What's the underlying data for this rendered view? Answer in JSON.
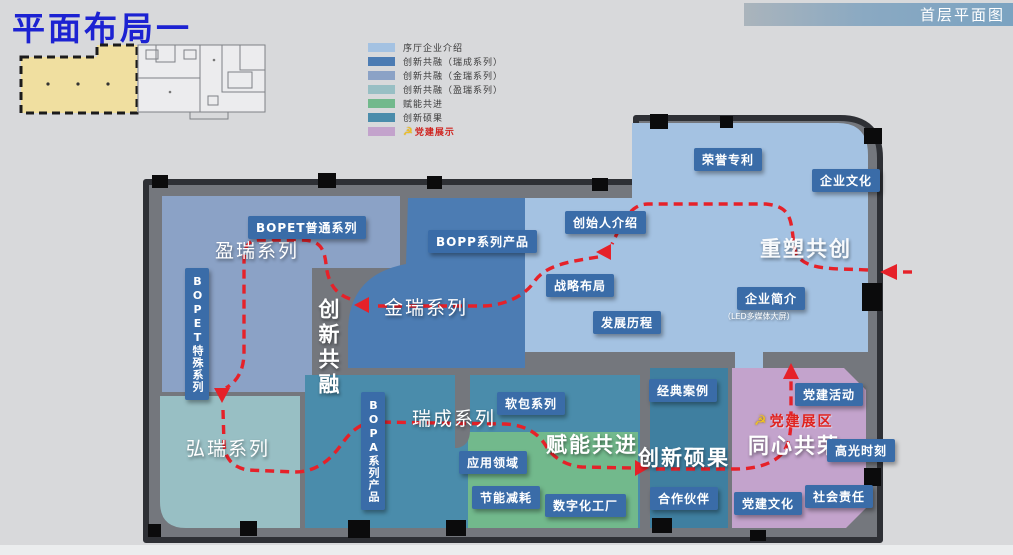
{
  "title": "平面布局一",
  "header": {
    "right_label": "首层平面图"
  },
  "legend": {
    "items": [
      {
        "label": "序厅企业介绍",
        "color": "#a4c2e2"
      },
      {
        "label": "创新共融（瑞成系列）",
        "color": "#4c7cb3"
      },
      {
        "label": "创新共融（金瑞系列）",
        "color": "#8ba2c6"
      },
      {
        "label": "创新共融（盈瑞系列）",
        "color": "#98bfc4"
      },
      {
        "label": "赋能共进",
        "color": "#72b98c"
      },
      {
        "label": "创新硕果",
        "color": "#4a8cab"
      },
      {
        "label": "党建展示",
        "color": "#c3a3cc",
        "text_color": "#cf2420",
        "icon": "party-emblem"
      }
    ]
  },
  "map": {
    "party_emblem_glyph": "☭",
    "zone_titles": {
      "yingrui": "盈瑞系列",
      "jinrui": "金瑞系列",
      "hongrui": "弘瑞系列",
      "ruicheng": "瑞成系列",
      "chuangxin_gongrong": "创新共融",
      "chongsu_gongchuang": "重塑共创",
      "funeng_gongjin": "赋能共进",
      "chuangxin_shuoguo": "创新硕果",
      "tongxin_gongrong": "同心共荣",
      "party_zone": "党建展区"
    },
    "room_labels": {
      "bopet_normal": "BOPET普通系列",
      "bopp": "BOPP系列产品",
      "bopet_special": "BOPET特殊系列",
      "bopa": "BOPA系列产品",
      "founder": "创始人介绍",
      "honor": "荣誉专利",
      "culture": "企业文化",
      "strategy": "战略布局",
      "history": "发展历程",
      "profile": "企业简介",
      "profile_sub": "（LED多媒体大屏）",
      "soft_pack": "软包系列",
      "application": "应用领域",
      "energy": "节能减耗",
      "digital": "数字化工厂",
      "cases": "经典案例",
      "partners": "合作伙伴",
      "party_activity": "党建活动",
      "highlight": "高光时刻",
      "party_culture": "党建文化",
      "social": "社会责任"
    }
  },
  "colors": {
    "page_bg": "#d8d9db",
    "title_blue": "#1c22d2",
    "header_bar": "#7ba3c1",
    "floor_gray": "#74777d",
    "wall_dark": "#2e3035",
    "zone_lobby": "#a4c2e2",
    "zone_blue": "#4c7cb3",
    "zone_slate": "#8ba2c6",
    "zone_tealgray": "#98bfc4",
    "zone_green": "#72b98c",
    "zone_tealblue": "#4a8cab",
    "zone_pink": "#c3a3cc",
    "label_box": "#3a6ca8",
    "route_red": "#e62129",
    "thumb_yellow": "#f0dfa0",
    "emblem_yellow": "#f2c31f"
  }
}
